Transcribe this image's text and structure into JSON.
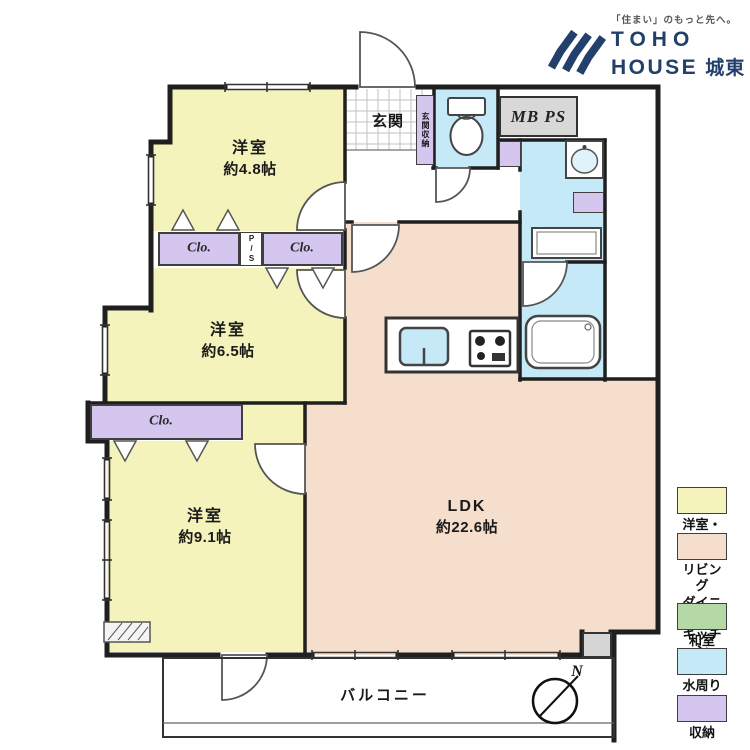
{
  "logo": {
    "tagline": "「住まい」のもっと先へ。",
    "brand_top": "TOHO",
    "brand_bottom": "HOUSE",
    "brand_area": "城東"
  },
  "plan": {
    "rooms": {
      "bedroom_small": {
        "name": "洋室",
        "size": "約4.8帖"
      },
      "bedroom_mid": {
        "name": "洋室",
        "size": "約6.5帖"
      },
      "bedroom_large": {
        "name": "洋室",
        "size": "約9.1帖"
      },
      "ldk": {
        "name": "LDK",
        "size": "約22.6帖"
      }
    },
    "entrance_label": "玄関",
    "entrance_storage_label": "玄関収納",
    "balcony_label": "バルコニー",
    "mb_ps_label": "MB PS",
    "closet_label": "Clo.",
    "pipe_space_label": "P/S",
    "compass_north": "N"
  },
  "legend": {
    "items": [
      {
        "label": "洋室・納戸",
        "color": "#f3f3bb"
      },
      {
        "label": "リビング\nダイニング\nキッチン",
        "color": "#f5dfcc"
      },
      {
        "label": "和室",
        "color": "#b4d8a6"
      },
      {
        "label": "水周り",
        "color": "#c5e9f7"
      },
      {
        "label": "収納",
        "color": "#d4c6ee"
      }
    ]
  },
  "colors": {
    "room_yellow": "#f3f3bb",
    "ldk_peach": "#f5dfcc",
    "water_blue": "#c5e9f7",
    "storage_purple": "#d4c6ee",
    "brand_navy": "#22406b",
    "mb_ps_gray": "#d8d8d8",
    "wall": "#1f1f1f"
  }
}
